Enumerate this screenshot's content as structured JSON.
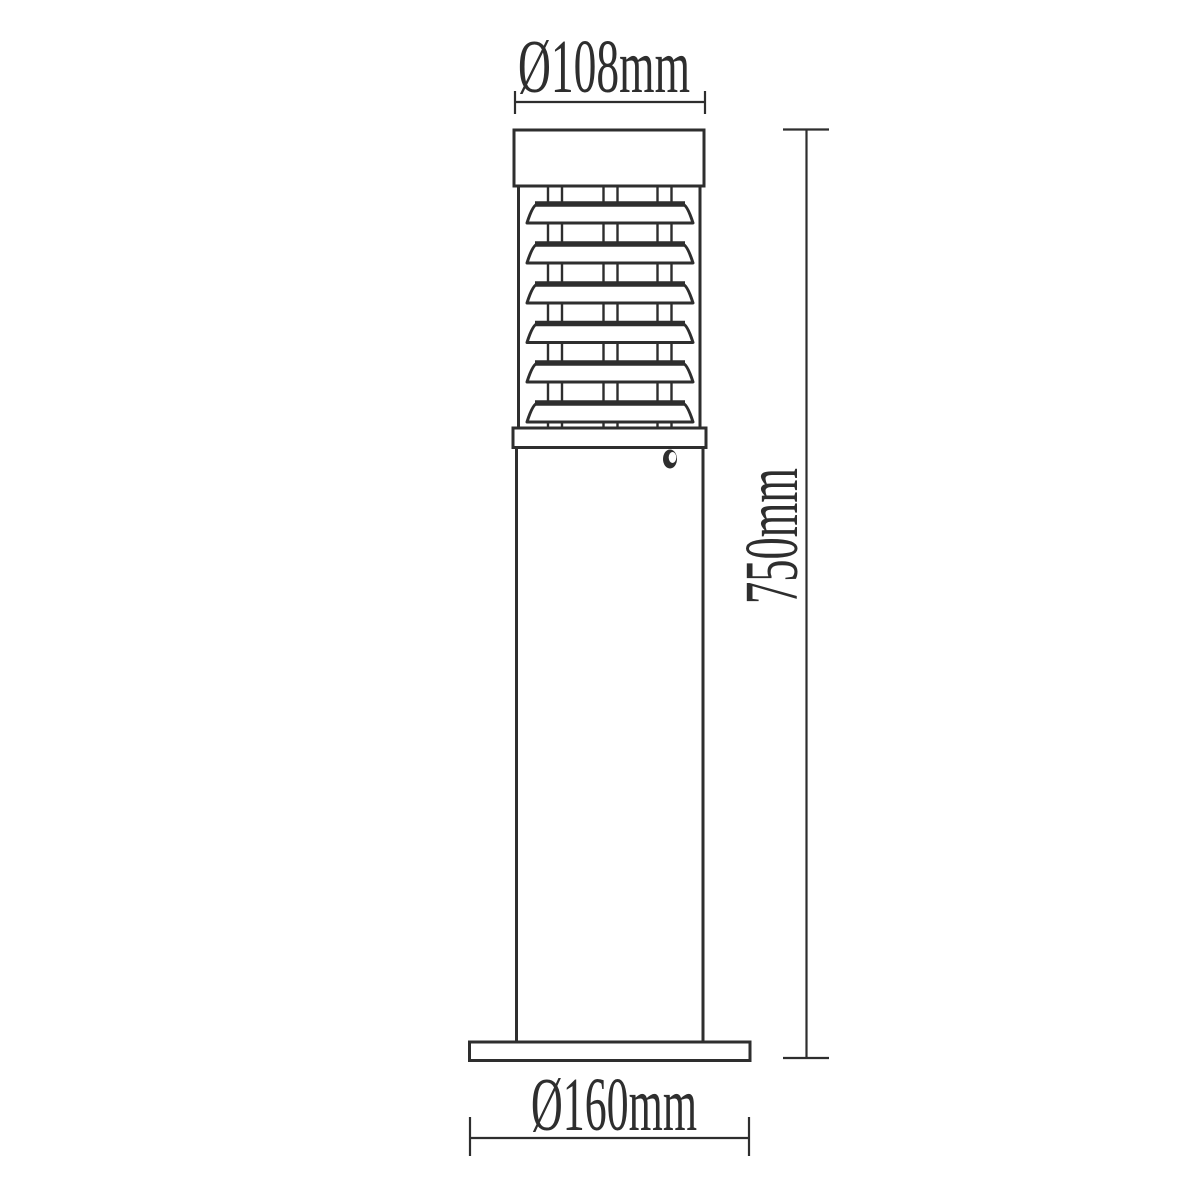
{
  "drawing": {
    "dimensions": {
      "top_diameter": "Ø108mm",
      "height": "750mm",
      "base_diameter": "Ø160mm"
    },
    "colors": {
      "line": "#2e2e2e",
      "background": "#ffffff"
    }
  }
}
